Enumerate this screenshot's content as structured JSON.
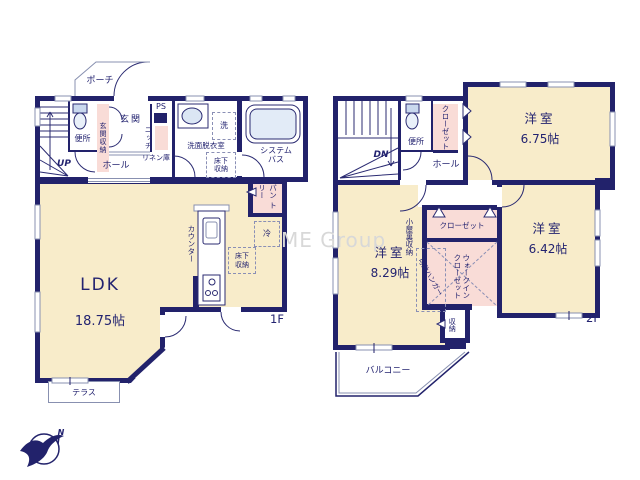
{
  "watermark": "ME Group",
  "compass": {
    "north_label": "N"
  },
  "floor1": {
    "floor_label": "1F",
    "porch": "ポーチ",
    "stairs_up": "UP",
    "toilet": "便所",
    "entrance_storage": "玄関収納",
    "entrance": "玄関",
    "ps": "PS",
    "niche": "ニッチ",
    "linen": "リネン庫",
    "hall": "ホール",
    "washer": "洗",
    "washroom": "洗面脱衣室",
    "underfloor_storage_wash": "床下\n収納",
    "system_bath": "システム\nバス",
    "ldk_name": "LDK",
    "ldk_size": "18.75帖",
    "counter": "カウンター",
    "pantry": "パン\nトリー",
    "fridge": "冷",
    "underfloor_storage_ldk": "床下\n収納",
    "terrace": "テラス"
  },
  "floor2": {
    "floor_label": "2F",
    "stairs_down": "DN",
    "toilet": "便所",
    "closet_upper": "クローゼット",
    "hall": "ホール",
    "room_a_name": "洋室",
    "room_a_size": "6.75帖",
    "room_b_name": "洋室",
    "room_b_size": "8.29帖",
    "room_c_name": "洋室",
    "room_c_size": "6.42帖",
    "attic_storage": "小屋裏収納",
    "closet_mid": "クローゼット",
    "walk_in_closet": "ウォークイン\nクローゼット",
    "movable_hanger": "可動ハンガー",
    "storage": "収納",
    "balcony": "バルコニー"
  }
}
